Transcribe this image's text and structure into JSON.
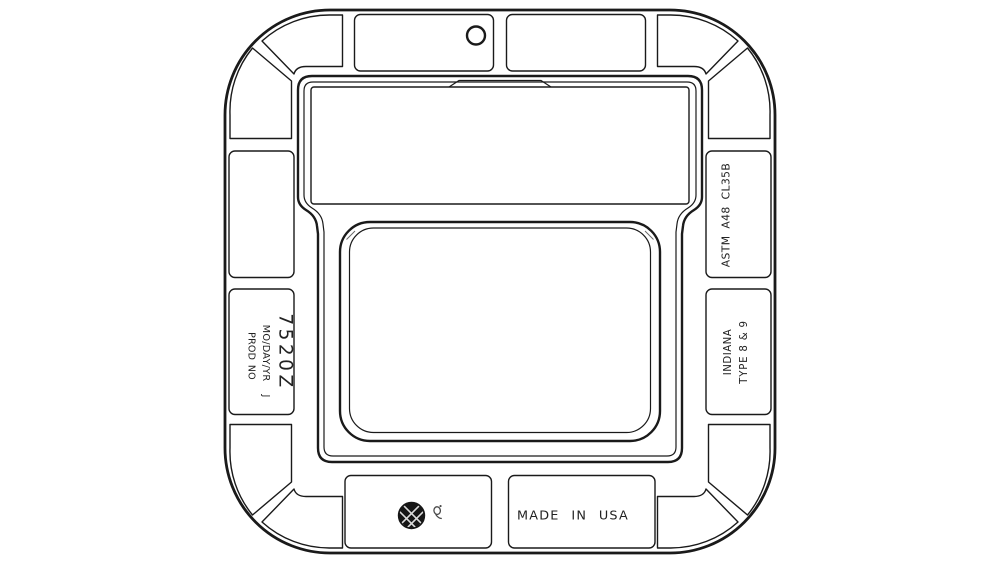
{
  "page": {
    "background": "#ffffff",
    "line_color": "#1a1a1a"
  },
  "drawing": {
    "description": "Plan view technical drawing of a square cast frame with rounded-corner flange ring, segmented rib panels, pick hole and recessed cover opening",
    "labels": {
      "part_number": "7520Z",
      "date_code": "MO/DAY/YR",
      "inspector_initial": "J",
      "prod_no": "PROD NO",
      "material_spec": "ASTM A48 CL35B",
      "state": "INDIANA",
      "type": "TYPE 8 & 9",
      "origin": "MADE IN USA"
    },
    "icons": {
      "pick_hole": "pick-hole-icon",
      "foundry_logo": "foundry-logo-icon",
      "stamp": "foundry-stamp-icon"
    }
  }
}
